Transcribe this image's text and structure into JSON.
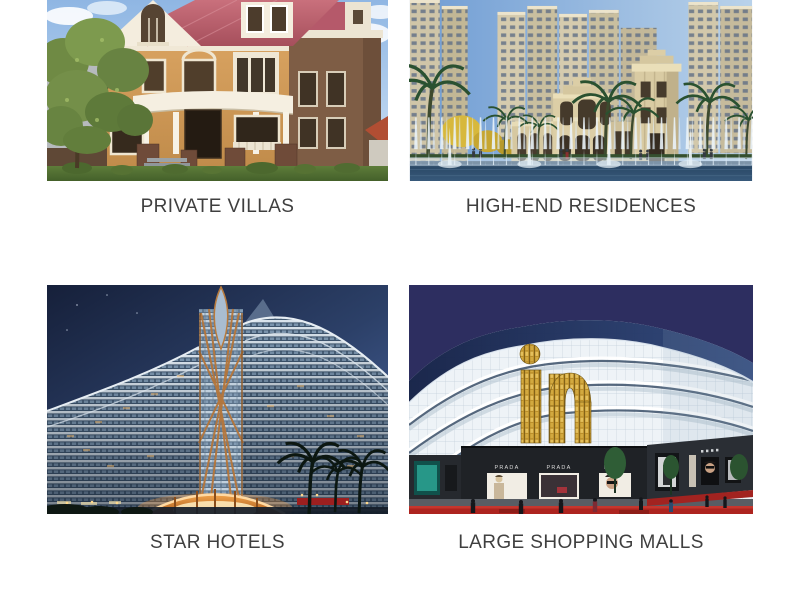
{
  "cards": [
    {
      "id": "private-villas",
      "caption": "PRIVATE VILLAS"
    },
    {
      "id": "high-end-residences",
      "caption": "HIGH-END RESIDENCES"
    },
    {
      "id": "star-hotels",
      "caption": "STAR HOTELS"
    },
    {
      "id": "large-shopping-malls",
      "caption": "LARGE SHOPPING MALLS"
    }
  ],
  "mall_signage": {
    "logo_text": "in",
    "store_label_1": "PRADA",
    "store_label_2": "PRADA",
    "store_label_3": "PRADA"
  },
  "colors": {
    "background": "#ffffff",
    "caption_text": "#3f3f3f",
    "mall_logo_gold": "#c09a33",
    "carpet_red": "#ad241f"
  }
}
